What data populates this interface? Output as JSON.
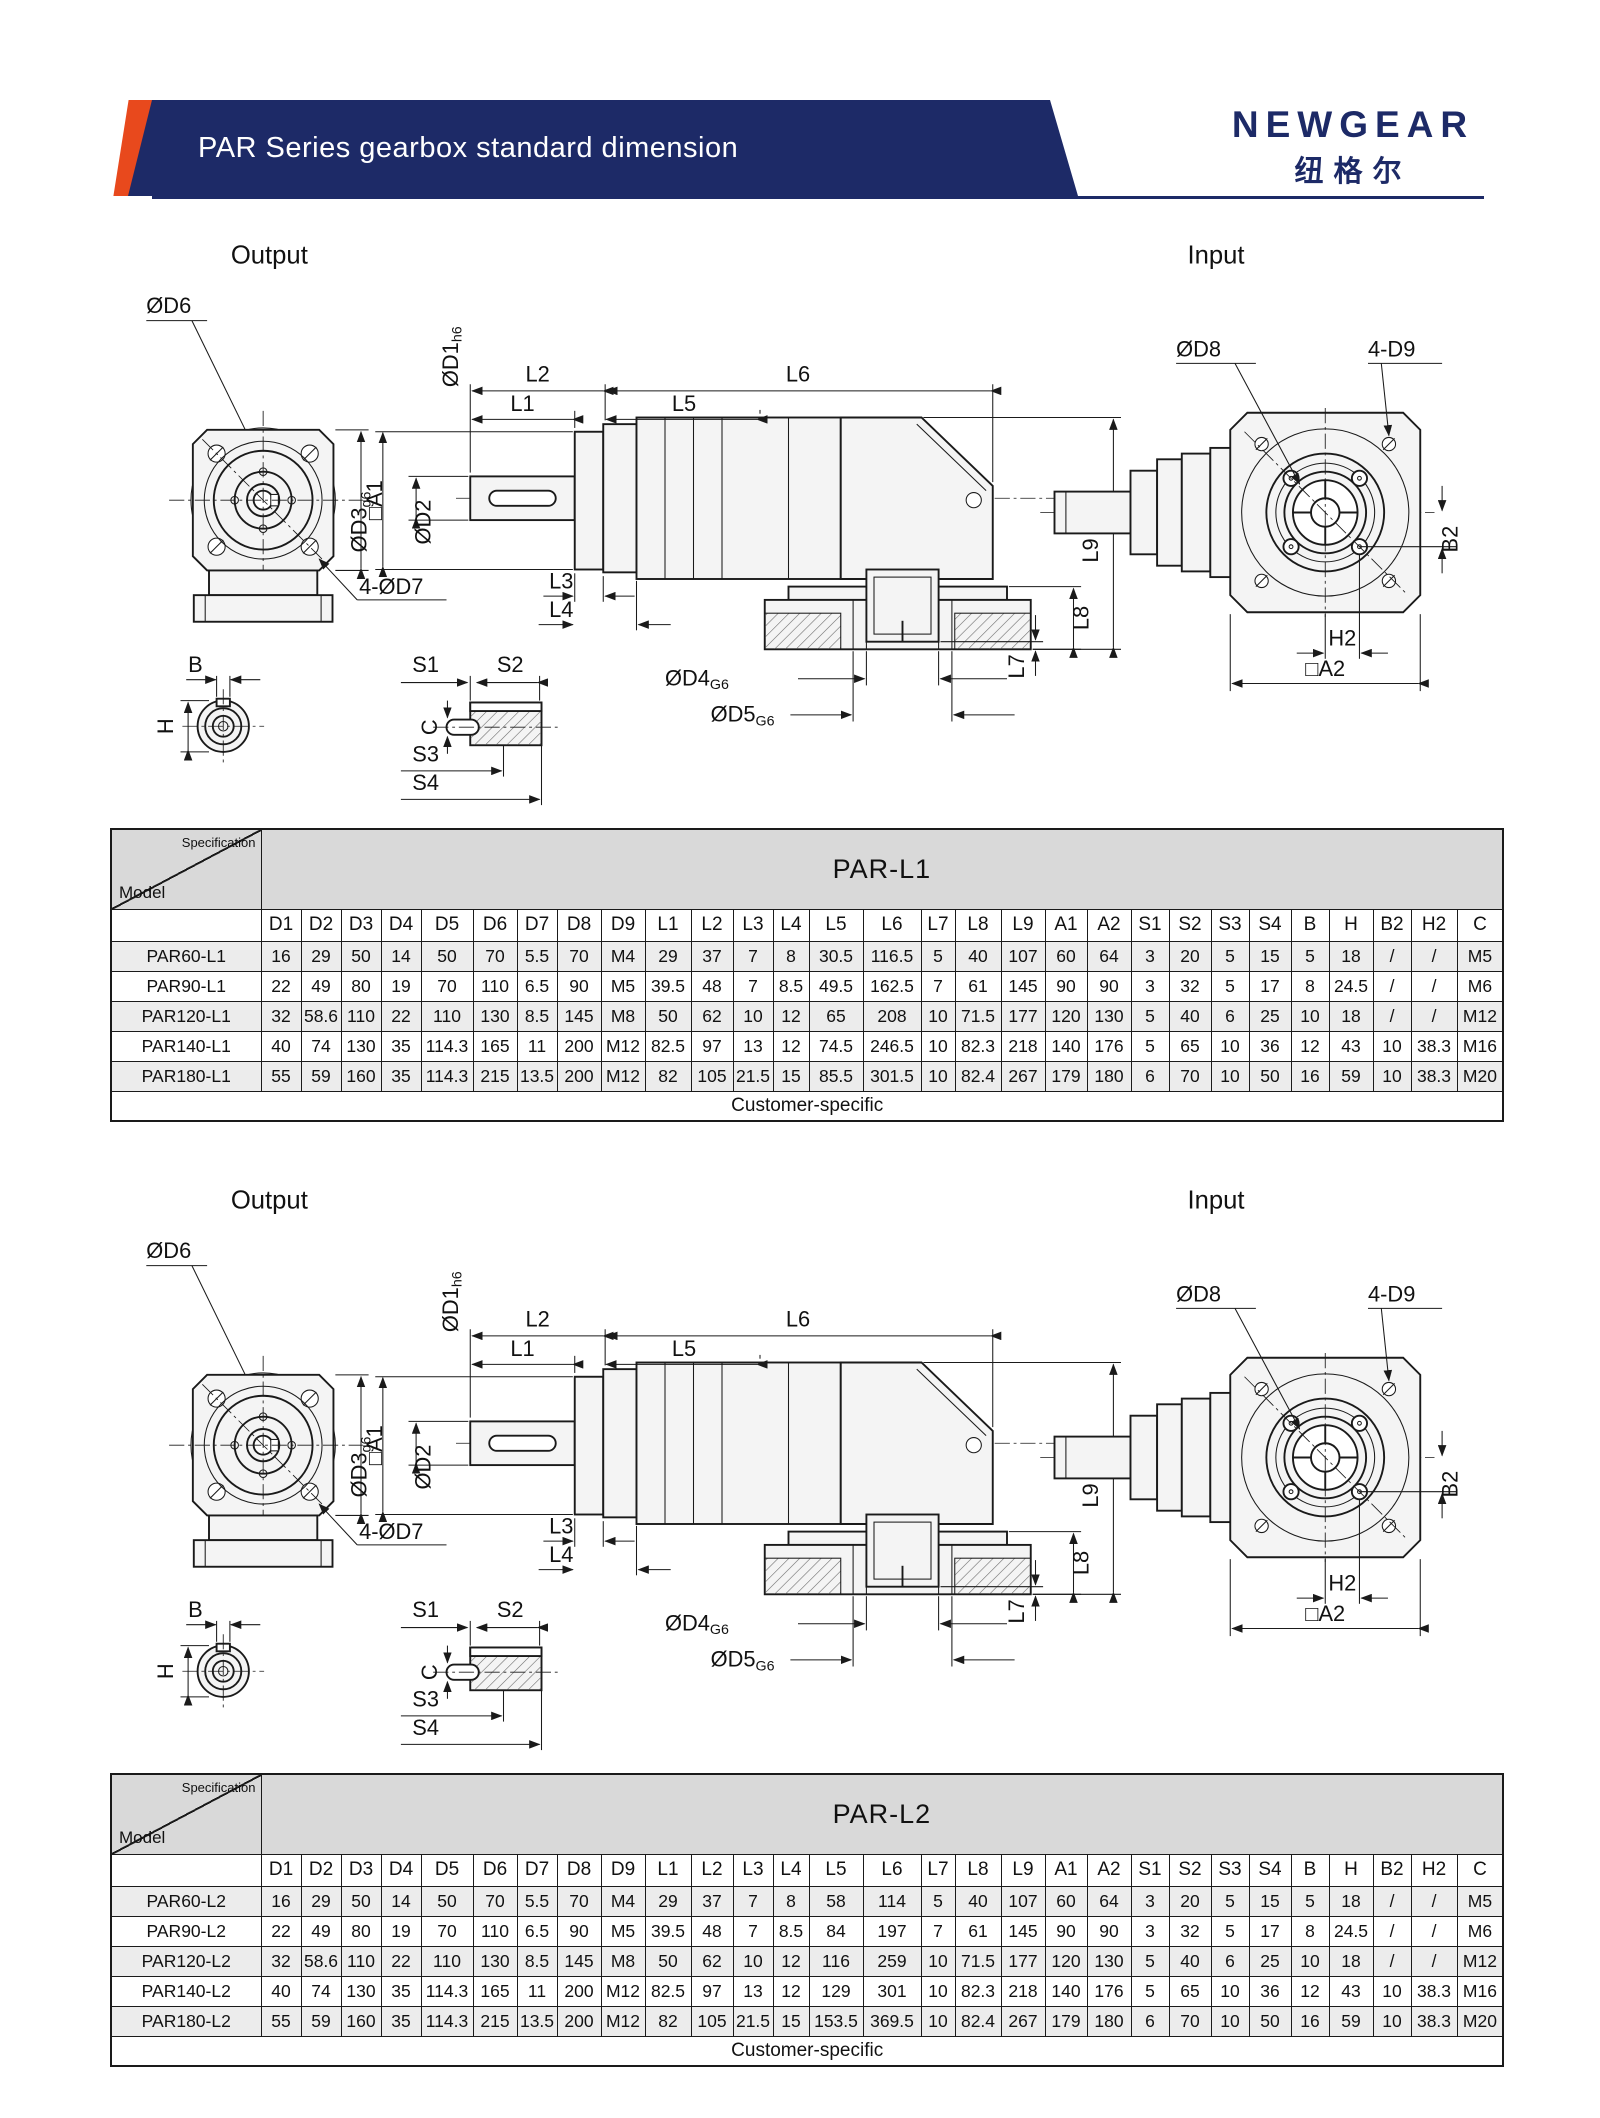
{
  "header": {
    "title": "PAR Series gearbox standard dimension",
    "brand": "NEWGEAR",
    "brand_cn": "纽格尔"
  },
  "colors": {
    "accent": "#e8491d",
    "navy": "#1d2a67",
    "table_grey": "#d9d9d9",
    "row_stripe": "#ececec"
  },
  "drawing": {
    "output_title": "Output",
    "input_title": "Input",
    "labels": {
      "od6": "ØD6",
      "a1": "□A1",
      "od7": "4-ØD7",
      "b": "B",
      "h": "H",
      "s1": "S1",
      "s2": "S2",
      "s3": "S3",
      "s4": "S4",
      "c": "C",
      "l1": "L1",
      "l2": "L2",
      "l3": "L3",
      "l4": "L4",
      "l5": "L5",
      "l6": "L6",
      "l7": "L7",
      "l8": "L8",
      "l9": "L9",
      "od1_main": "ØD1",
      "od1_sub": "h6",
      "od2": "ØD2",
      "od3_main": "ØD3",
      "od3_sub": "g6",
      "od4_main": "ØD4",
      "od4_sub": "G6",
      "od5_main": "ØD5",
      "od5_sub": "G6",
      "od8": "ØD8",
      "d9": "4-D9",
      "b2": "B2",
      "h2": "H2",
      "a2": "□A2"
    }
  },
  "tables": [
    {
      "corner_top": "Specification",
      "corner_bottom": "Model",
      "title": "PAR-L1",
      "columns": [
        "D1",
        "D2",
        "D3",
        "D4",
        "D5",
        "D6",
        "D7",
        "D8",
        "D9",
        "L1",
        "L2",
        "L3",
        "L4",
        "L5",
        "L6",
        "L7",
        "L8",
        "L9",
        "A1",
        "A2",
        "S1",
        "S2",
        "S3",
        "S4",
        "B",
        "H",
        "B2",
        "H2",
        "C"
      ],
      "rows": [
        {
          "model": "PAR60-L1",
          "values": [
            "16",
            "29",
            "50",
            "14",
            "50",
            "70",
            "5.5",
            "70",
            "M4",
            "29",
            "37",
            "7",
            "8",
            "30.5",
            "116.5",
            "5",
            "40",
            "107",
            "60",
            "64",
            "3",
            "20",
            "5",
            "15",
            "5",
            "18",
            "/",
            "/",
            "M5"
          ]
        },
        {
          "model": "PAR90-L1",
          "values": [
            "22",
            "49",
            "80",
            "19",
            "70",
            "110",
            "6.5",
            "90",
            "M5",
            "39.5",
            "48",
            "7",
            "8.5",
            "49.5",
            "162.5",
            "7",
            "61",
            "145",
            "90",
            "90",
            "3",
            "32",
            "5",
            "17",
            "8",
            "24.5",
            "/",
            "/",
            "M6"
          ]
        },
        {
          "model": "PAR120-L1",
          "values": [
            "32",
            "58.6",
            "110",
            "22",
            "110",
            "130",
            "8.5",
            "145",
            "M8",
            "50",
            "62",
            "10",
            "12",
            "65",
            "208",
            "10",
            "71.5",
            "177",
            "120",
            "130",
            "5",
            "40",
            "6",
            "25",
            "10",
            "18",
            "/",
            "/",
            "M12"
          ]
        },
        {
          "model": "PAR140-L1",
          "values": [
            "40",
            "74",
            "130",
            "35",
            "114.3",
            "165",
            "11",
            "200",
            "M12",
            "82.5",
            "97",
            "13",
            "12",
            "74.5",
            "246.5",
            "10",
            "82.3",
            "218",
            "140",
            "176",
            "5",
            "65",
            "10",
            "36",
            "12",
            "43",
            "10",
            "38.3",
            "M16"
          ]
        },
        {
          "model": "PAR180-L1",
          "values": [
            "55",
            "59",
            "160",
            "35",
            "114.3",
            "215",
            "13.5",
            "200",
            "M12",
            "82",
            "105",
            "21.5",
            "15",
            "85.5",
            "301.5",
            "10",
            "82.4",
            "267",
            "179",
            "180",
            "6",
            "70",
            "10",
            "50",
            "16",
            "59",
            "10",
            "38.3",
            "M20"
          ]
        }
      ],
      "footer": "Customer-specific"
    },
    {
      "corner_top": "Specification",
      "corner_bottom": "Model",
      "title": "PAR-L2",
      "columns": [
        "D1",
        "D2",
        "D3",
        "D4",
        "D5",
        "D6",
        "D7",
        "D8",
        "D9",
        "L1",
        "L2",
        "L3",
        "L4",
        "L5",
        "L6",
        "L7",
        "L8",
        "L9",
        "A1",
        "A2",
        "S1",
        "S2",
        "S3",
        "S4",
        "B",
        "H",
        "B2",
        "H2",
        "C"
      ],
      "rows": [
        {
          "model": "PAR60-L2",
          "values": [
            "16",
            "29",
            "50",
            "14",
            "50",
            "70",
            "5.5",
            "70",
            "M4",
            "29",
            "37",
            "7",
            "8",
            "58",
            "114",
            "5",
            "40",
            "107",
            "60",
            "64",
            "3",
            "20",
            "5",
            "15",
            "5",
            "18",
            "/",
            "/",
            "M5"
          ]
        },
        {
          "model": "PAR90-L2",
          "values": [
            "22",
            "49",
            "80",
            "19",
            "70",
            "110",
            "6.5",
            "90",
            "M5",
            "39.5",
            "48",
            "7",
            "8.5",
            "84",
            "197",
            "7",
            "61",
            "145",
            "90",
            "90",
            "3",
            "32",
            "5",
            "17",
            "8",
            "24.5",
            "/",
            "/",
            "M6"
          ]
        },
        {
          "model": "PAR120-L2",
          "values": [
            "32",
            "58.6",
            "110",
            "22",
            "110",
            "130",
            "8.5",
            "145",
            "M8",
            "50",
            "62",
            "10",
            "12",
            "116",
            "259",
            "10",
            "71.5",
            "177",
            "120",
            "130",
            "5",
            "40",
            "6",
            "25",
            "10",
            "18",
            "/",
            "/",
            "M12"
          ]
        },
        {
          "model": "PAR140-L2",
          "values": [
            "40",
            "74",
            "130",
            "35",
            "114.3",
            "165",
            "11",
            "200",
            "M12",
            "82.5",
            "97",
            "13",
            "12",
            "129",
            "301",
            "10",
            "82.3",
            "218",
            "140",
            "176",
            "5",
            "65",
            "10",
            "36",
            "12",
            "43",
            "10",
            "38.3",
            "M16"
          ]
        },
        {
          "model": "PAR180-L2",
          "values": [
            "55",
            "59",
            "160",
            "35",
            "114.3",
            "215",
            "13.5",
            "200",
            "M12",
            "82",
            "105",
            "21.5",
            "15",
            "153.5",
            "369.5",
            "10",
            "82.4",
            "267",
            "179",
            "180",
            "6",
            "70",
            "10",
            "50",
            "16",
            "59",
            "10",
            "38.3",
            "M20"
          ]
        }
      ],
      "footer": "Customer-specific"
    }
  ]
}
